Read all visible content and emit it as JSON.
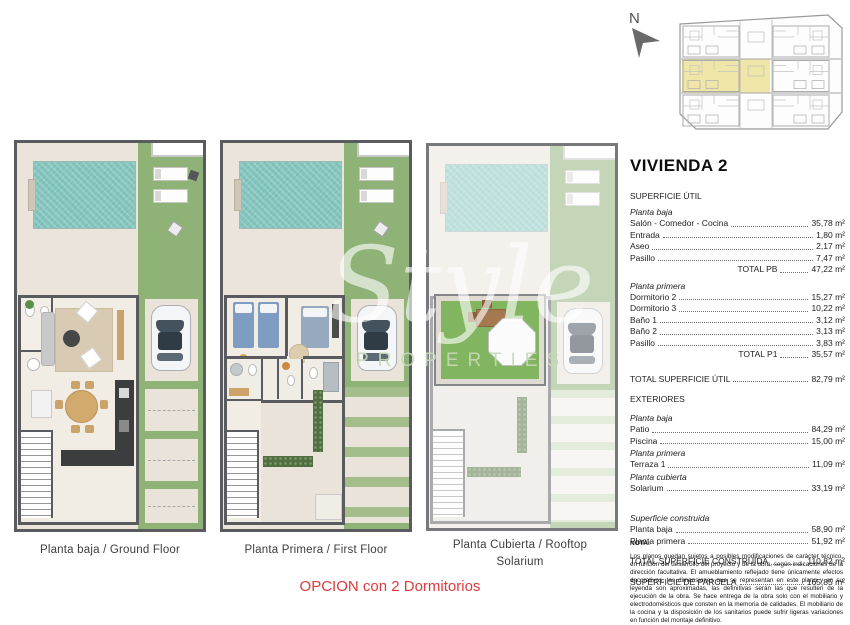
{
  "watermark": {
    "script": "Style",
    "caps": "PROPERTIES"
  },
  "plans": {
    "ground": {
      "caption": "Planta baja / Ground Floor"
    },
    "first": {
      "caption": "Planta Primera / First Floor"
    },
    "rooftop": {
      "caption_line1": "Planta Cubierta / Rooftop",
      "caption_line2": "Solarium"
    }
  },
  "option_note": "OPCION con 2 Dormitorios",
  "site_plan": {
    "north_label": "N",
    "highlight_color": "#efe6a7"
  },
  "panel": {
    "title": "VIVIENDA 2",
    "subtitle": "SUPERFICIE ÚTIL",
    "planta_baja": {
      "header": "Planta baja",
      "rows": [
        {
          "label": "Salón - Comedor - Cocina",
          "value": "35,78 m²"
        },
        {
          "label": "Entrada",
          "value": "1,80 m²"
        },
        {
          "label": "Aseo",
          "value": "2,17 m²"
        },
        {
          "label": "Pasillo",
          "value": "7,47 m²"
        }
      ],
      "total_label": "TOTAL PB",
      "total_value": "47,22 m²"
    },
    "planta_primera": {
      "header": "Planta primera",
      "rows": [
        {
          "label": "Dormitorio 2",
          "value": "15,27 m²"
        },
        {
          "label": "Dormitorio 3",
          "value": "10,22 m²"
        },
        {
          "label": "Baño 1",
          "value": "3,12 m²"
        },
        {
          "label": "Baño 2",
          "value": "3,13 m²"
        },
        {
          "label": "Pasillo",
          "value": "3,83 m²"
        }
      ],
      "total_label": "TOTAL P1",
      "total_value": "35,57 m²"
    },
    "total_util": {
      "label": "TOTAL SUPERFICIE ÚTIL",
      "value": "82,79 m²"
    },
    "exteriores": {
      "header": "EXTERIORES",
      "g1_header": "Planta baja",
      "g1_rows": [
        {
          "label": "Patio",
          "value": "84,29 m²"
        },
        {
          "label": "Piscina",
          "value": "15,00 m²"
        }
      ],
      "g2_header": "Planta primera",
      "g2_rows": [
        {
          "label": "Terraza 1",
          "value": "11,09 m²"
        }
      ],
      "g3_header": "Planta cubierta",
      "g3_rows": [
        {
          "label": "Solarium",
          "value": "33,19 m²"
        }
      ]
    },
    "construida": {
      "header": "Superficie construida",
      "rows": [
        {
          "label": "Planta baja",
          "value": "58,90 m²"
        },
        {
          "label": "Planta primera",
          "value": "51,92 m²"
        }
      ]
    },
    "total_construida": {
      "label": "TOTAL SUPERFICIE CONSTRUÍDA",
      "value": "110,82 m²"
    },
    "parcela": {
      "label": "SUPERFICIE DE PARCELA",
      "value": "165,85 m²"
    },
    "nota": {
      "label": "NOTA:",
      "text": "Los planos quedan sujetos a posibles modificaciones de carácter técnico, en función del desarrollo del proyecto y de la obra, según indicaciones de la dirección facultativa. El amueblamiento reflejado tiene únicamente efectos decorativos, las dimensiones que se representan en este plano y en su leyenda son aproximadas, las definitivas serán las que resulten de la ejecución de la obra. Se hace entrega de la obra solo con el mobiliario y electrodomésticos que consten en la memoria de calidades. El mobiliario de la cocina y la disposición de los sanitarios puede sufrir ligeras variaciones en función del montaje definitivo."
    }
  },
  "colors": {
    "grass": "#8fb277",
    "pool": "#84c6be",
    "deck": "#e9e3d9",
    "wall": "#5a5b5f",
    "accent_red": "#e03a3a",
    "highlight": "#efe6a7",
    "solarium_turf": "#82b55f"
  }
}
